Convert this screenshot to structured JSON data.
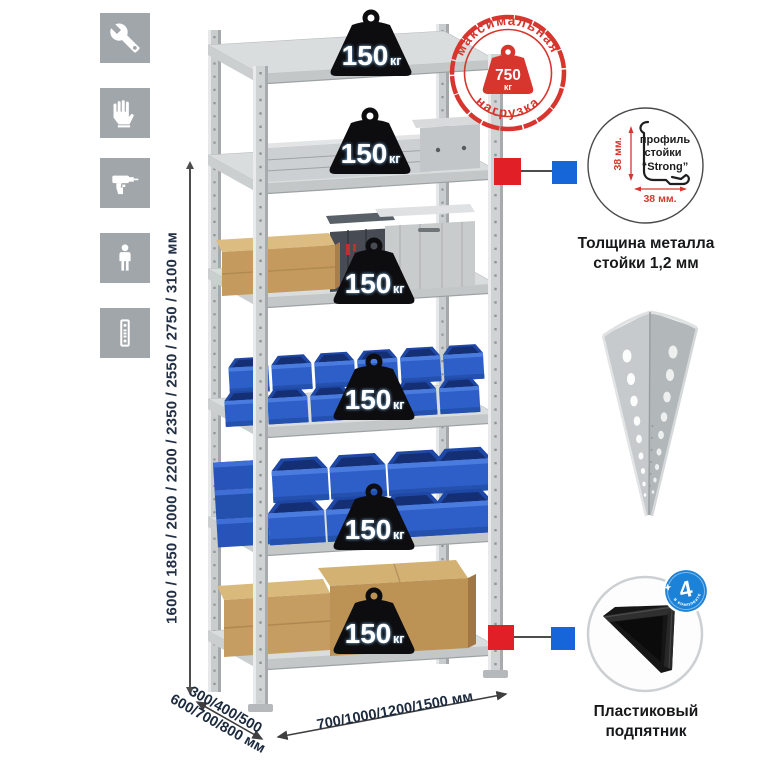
{
  "colors": {
    "icon_tile": "#a1a6aa",
    "rack_metal": "#cfd3d4",
    "bin_blue": "#2e5fc9",
    "cardboard": "#c49a5f",
    "stamp_red": "#d6362e",
    "callout_red": "#e01f26",
    "callout_blue": "#1666d9",
    "badge_blue": "#1b82d8",
    "dim_text": "#222f45"
  },
  "assembly_icons": {
    "items": [
      {
        "name": "wrench"
      },
      {
        "name": "gloves"
      },
      {
        "name": "drill"
      },
      {
        "name": "person"
      },
      {
        "name": "rack-post"
      }
    ]
  },
  "dimensions": {
    "height_label": "1600 / 1850 / 2000 / 2200 / 2350 / 2550 / 2750 / 3100 мм",
    "depth_label_line1": "300/400/500",
    "depth_label_line2": "600/700/800 мм",
    "width_label": "700/1000/1200/1500 мм"
  },
  "shelves": [
    {
      "load_value": "150",
      "load_unit": "кг"
    },
    {
      "load_value": "150",
      "load_unit": "кг"
    },
    {
      "load_value": "150",
      "load_unit": "кг"
    },
    {
      "load_value": "150",
      "load_unit": "кг"
    },
    {
      "load_value": "150",
      "load_unit": "кг"
    },
    {
      "load_value": "150",
      "load_unit": "кг"
    }
  ],
  "max_load_stamp": {
    "text_top": "максимальная",
    "text_bottom": "нагрузка",
    "value": "750",
    "unit": "кг"
  },
  "profile_detail": {
    "line1": "профиль",
    "line2": "стойки",
    "line3": "“Strong”",
    "dim_vertical": "38 мм.",
    "dim_horizontal": "38 мм.",
    "caption_line1": "Толщина металла",
    "caption_line2": "стойки 1,2 мм"
  },
  "foot_detail": {
    "badge_value": "4",
    "badge_ring_text": "в комплекте",
    "caption_line1": "Пластиковый",
    "caption_line2": "подпятник"
  }
}
